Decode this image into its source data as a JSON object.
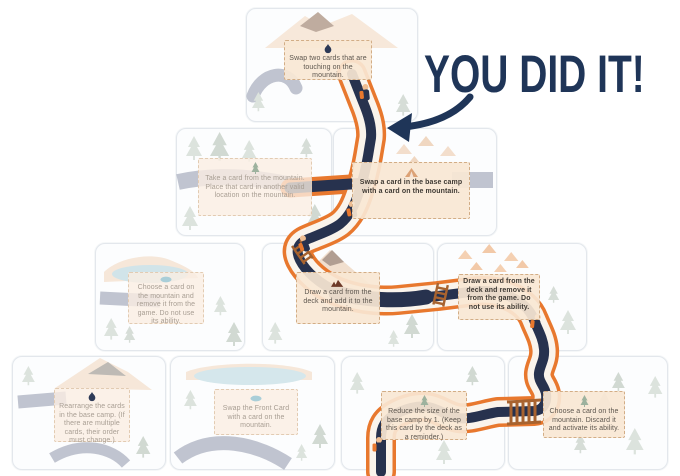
{
  "banner": {
    "text": "YOU DID IT!"
  },
  "colors": {
    "banner_navy": "#1f3558",
    "trail_navy": "#27324e",
    "route_outline_orange": "#e8782e",
    "route_corridor_cream": "#faf4ec",
    "card_background": "#fcfdfe",
    "text_box_background": "#f9e7d4",
    "text_box_border": "#d2ad86",
    "art_peach": "#f2d7bc",
    "art_tree_sage": "#c2cec2",
    "art_lake_blue": "#aed0d8",
    "art_gray_trail": "#8f95a9",
    "ladder_brown": "#a8632f"
  },
  "cards": [
    {
      "name": "swap-two-touching-cards",
      "row": 1,
      "icon": "campfire-icon",
      "on_route": true,
      "text": "Swap two cards that are touching on the mountain."
    },
    {
      "name": "take-card-place-elsewhere",
      "row": 2,
      "icon": "pine-tree-icon",
      "on_route": false,
      "text": "Take a card from the mountain. Place that card in another valid location on the mountain."
    },
    {
      "name": "swap-base-camp-with-mountain",
      "row": 2,
      "icon": "tent-icon",
      "on_route": true,
      "text": "Swap a card in the base camp with a card on the mountain."
    },
    {
      "name": "choose-card-remove-from-game",
      "row": 3,
      "icon": "lake-icon",
      "on_route": false,
      "text": "Choose a card on the mountain and remove it from the game. Do not use its ability."
    },
    {
      "name": "draw-card-add-to-mountain",
      "row": 3,
      "icon": "mountain-icon",
      "on_route": true,
      "text": "Draw a card from the deck and add it to the mountain."
    },
    {
      "name": "draw-card-remove-from-game",
      "row": 3,
      "icon": "none",
      "on_route": true,
      "text": "Draw a card from the deck and remove it from the game. Do not use its ability."
    },
    {
      "name": "rearrange-base-camp",
      "row": 4,
      "icon": "campfire-icon",
      "on_route": false,
      "text": "Rearrange the cards in the base camp. (If there are multiple cards, their order must change.)"
    },
    {
      "name": "swap-front-card",
      "row": 4,
      "icon": "lake-icon",
      "on_route": false,
      "text": "Swap the Front Card with a card on the mountain."
    },
    {
      "name": "reduce-base-camp",
      "row": 4,
      "icon": "pine-tree-icon",
      "on_route": true,
      "text": "Reduce the size of the base camp by 1. (Keep this card by the deck as a reminder.)"
    },
    {
      "name": "choose-discard-activate",
      "row": 4,
      "icon": "pine-tree-icon",
      "on_route": true,
      "text": "Choose a card on the mountain. Discard it and activate its ability."
    }
  ]
}
